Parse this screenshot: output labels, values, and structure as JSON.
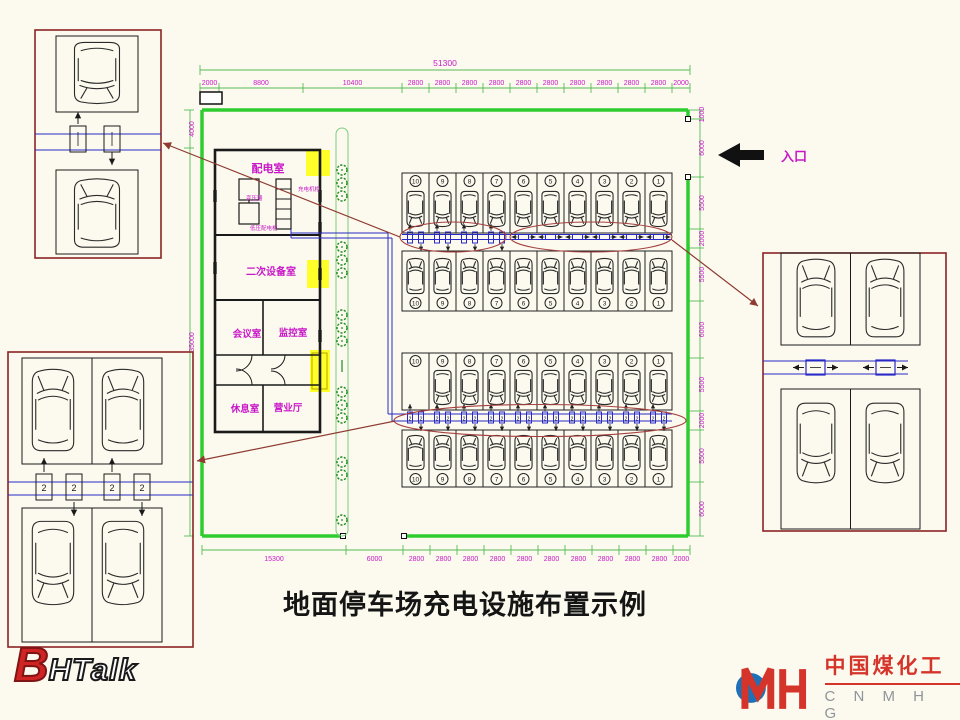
{
  "title": "地面停车场充电设施布置示例",
  "entrance_label": "入口",
  "dimensions": {
    "top_total": "51300",
    "top": [
      "2000",
      "8800",
      "10400",
      "2800",
      "2800",
      "2800",
      "2800",
      "2800",
      "2800",
      "2800",
      "2800",
      "2800",
      "2800",
      "2000"
    ],
    "bottom": [
      "15300",
      "6000",
      "2800",
      "2800",
      "2800",
      "2800",
      "2800",
      "2800",
      "2800",
      "2800",
      "2800",
      "2800",
      "2000"
    ],
    "left": [
      "4000",
      "35000"
    ],
    "right": [
      "1000",
      "6000",
      "5500",
      "2000",
      "5500",
      "6000",
      "5500",
      "2000",
      "5500",
      "6000"
    ]
  },
  "building": {
    "rooms": [
      "配电室",
      "二次设备室",
      "会议室",
      "监控室",
      "休息室",
      "营业厅"
    ],
    "equipment": [
      "变压器",
      "低压配电柜",
      "充电机柜"
    ]
  },
  "parking": {
    "stall_numbers": [
      "10",
      "9",
      "8",
      "7",
      "6",
      "5",
      "4",
      "3",
      "2",
      "1"
    ],
    "pile_label": "2"
  },
  "logos": {
    "bhtalk": {
      "b": "B",
      "rest": "HTalk"
    },
    "cnmhg": {
      "cn": "中国煤化工",
      "en": "C N M H G"
    }
  },
  "colors": {
    "background": "#FCFAEE",
    "wall_green": "#2FCC2F",
    "dim_green": "#55BB55",
    "dim_text_magenta": "#C817C8",
    "wire_blue": "#2929C8",
    "callout_red": "#8E3B32",
    "ellipse_red": "#A64040",
    "highlight_yellow": "#FFFF29",
    "logo_red": "#D5342B",
    "logo_blue": "#1D71B8"
  }
}
